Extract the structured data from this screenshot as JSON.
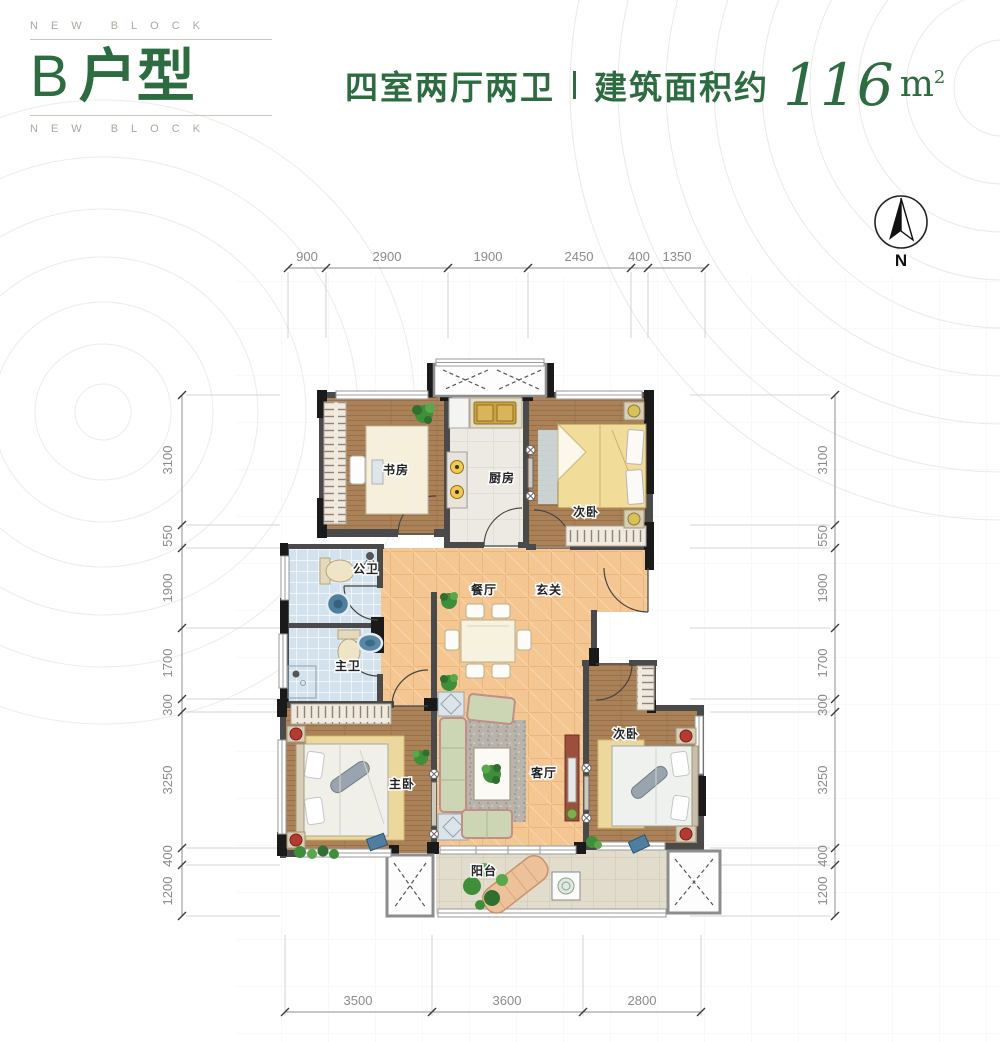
{
  "brand": {
    "eyebrow_top": "NEW BLOCK",
    "eyebrow_bottom": "NEW BLOCK",
    "unit_letter": "B",
    "unit_suffix": "户型"
  },
  "header": {
    "layout_text": "四室两厅两卫",
    "area_label": "建筑面积约",
    "area_value": "116",
    "area_unit_base": "m",
    "area_unit_sup": "2"
  },
  "compass": {
    "north_label": "N"
  },
  "rooms": {
    "study": "书房",
    "kitchen": "厨房",
    "bedroom_top": "次卧",
    "public_bath": "公卫",
    "dining": "餐厅",
    "foyer": "玄关",
    "master_bath": "主卫",
    "master_bedroom": "主卧",
    "living": "客厅",
    "bedroom_right": "次卧",
    "balcony": "阳台"
  },
  "dimensions": {
    "top": [
      "900",
      "2900",
      "1900",
      "2450",
      "400",
      "1350"
    ],
    "bottom": [
      "3500",
      "3600",
      "2800"
    ],
    "left": [
      "3100",
      "550",
      "1900",
      "1700",
      "300",
      "3250",
      "400",
      "1200"
    ],
    "right": [
      "3100",
      "550",
      "1900",
      "1700",
      "300",
      "3250",
      "400",
      "1200"
    ]
  },
  "colors": {
    "accent_green": "#2d6c41",
    "dim_text": "#8a8a8a",
    "wall": "#4a4a4a",
    "wood_floor": "#ab8158",
    "warm_tile": "#f4c792",
    "bath_tile": "#d3e2ec"
  }
}
